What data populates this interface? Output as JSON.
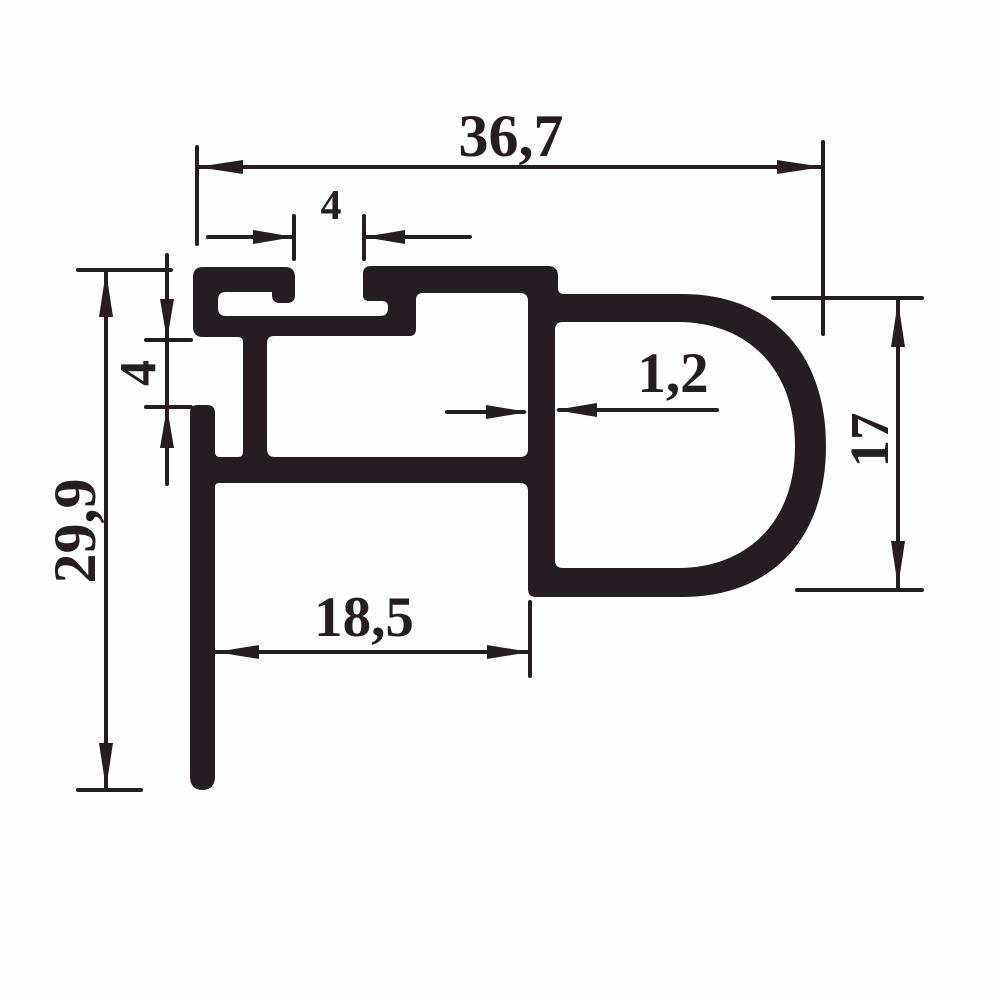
{
  "drawing": {
    "ink": "#251d21",
    "paper": "#fefefe",
    "labels": {
      "total_width": "36,7",
      "top_slot": "4",
      "left_gap": "4",
      "total_height": "29,9",
      "wall_thickness": "1,2",
      "bulb_height": "17",
      "leg_to_wall": "18,5"
    }
  }
}
